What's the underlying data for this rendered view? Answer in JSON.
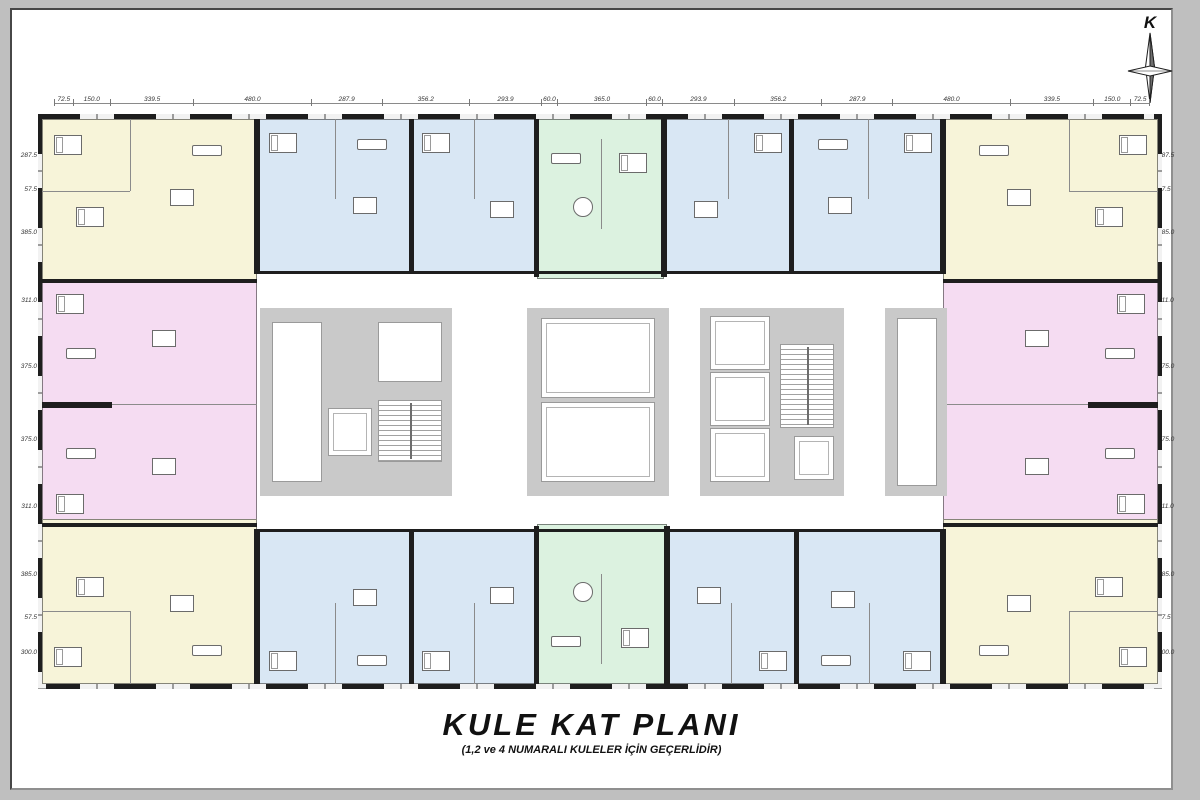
{
  "title": {
    "main": "KULE KAT PLANI",
    "subtitle": "(1,2 ve 4 NUMARALI KULELER İÇİN GEÇERLİDİR)"
  },
  "compass": {
    "north_label": "K"
  },
  "dimensions": {
    "top": [
      "72.5",
      "150.0",
      "339.5",
      "480.0",
      "287.9",
      "356.2",
      "293.9",
      "60.0",
      "365.0",
      "60.0",
      "293.9",
      "356.2",
      "287.9",
      "480.0",
      "339.5",
      "150.0",
      "72.5"
    ],
    "left": [
      "287.5",
      "57.5",
      "385.0",
      "311.0",
      "375.0",
      "375.0",
      "311.0",
      "385.0",
      "57.5",
      "300.0"
    ],
    "right": [
      "287.5",
      "57.5",
      "385.0",
      "311.0",
      "375.0",
      "375.0",
      "311.0",
      "385.0",
      "57.5",
      "300.0"
    ]
  },
  "palette": {
    "unit_yellow": "#f7f4d9",
    "unit_blue": "#d9e7f4",
    "unit_green": "#dcf2e0",
    "unit_pink": "#f5dcf2",
    "core_gray": "#c9c9c9",
    "wall_black": "#1e1e1e"
  }
}
